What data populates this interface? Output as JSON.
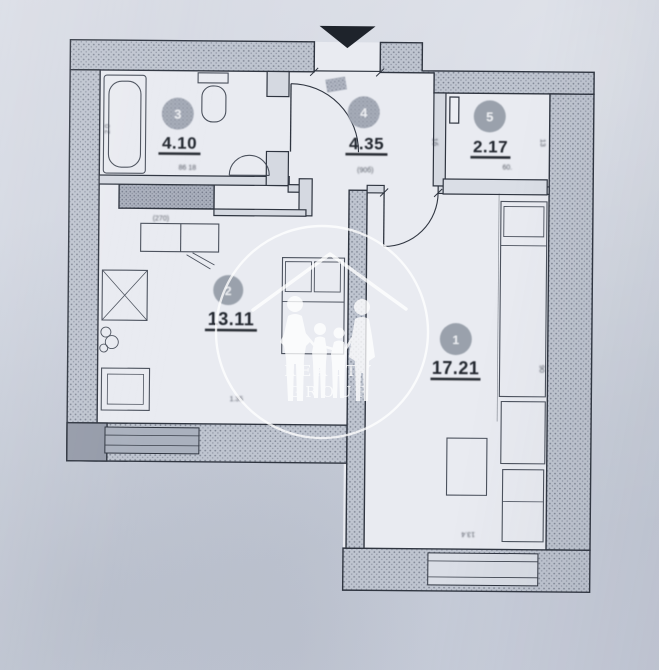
{
  "document": {
    "type": "apartment-floor-plan",
    "style": "scanned-photo"
  },
  "watermark": {
    "brand": "Realty Group",
    "line1": "REALTY",
    "line2": "GROUP"
  },
  "entrance": {
    "marker": "black-triangle-down"
  },
  "rooms": [
    {
      "name": "bedroom",
      "number": "1",
      "area": "17.21"
    },
    {
      "name": "living-kitchen",
      "number": "2",
      "area": "13.11"
    },
    {
      "name": "bathroom",
      "number": "3",
      "area": "4.10"
    },
    {
      "name": "hallway",
      "number": "4",
      "area": "4.35"
    },
    {
      "name": "wardrobe",
      "number": "5",
      "area": "2.17"
    }
  ],
  "dimension_labels": [
    {
      "text": "(90б)"
    },
    {
      "text": "(270)"
    },
    {
      "text": "86 18"
    },
    {
      "text": "2.0"
    },
    {
      "text": "90"
    },
    {
      "text": "13.4"
    },
    {
      "text": "1.35"
    },
    {
      "text": "60."
    },
    {
      "text": "1б"
    },
    {
      "text": "13"
    }
  ],
  "colors": {
    "paper": "#cdd2de",
    "ink": "#2f3540",
    "wall_stipple": "#bec4cf",
    "watermark": "#ffffff",
    "entrance_marker": "#1e232b"
  }
}
